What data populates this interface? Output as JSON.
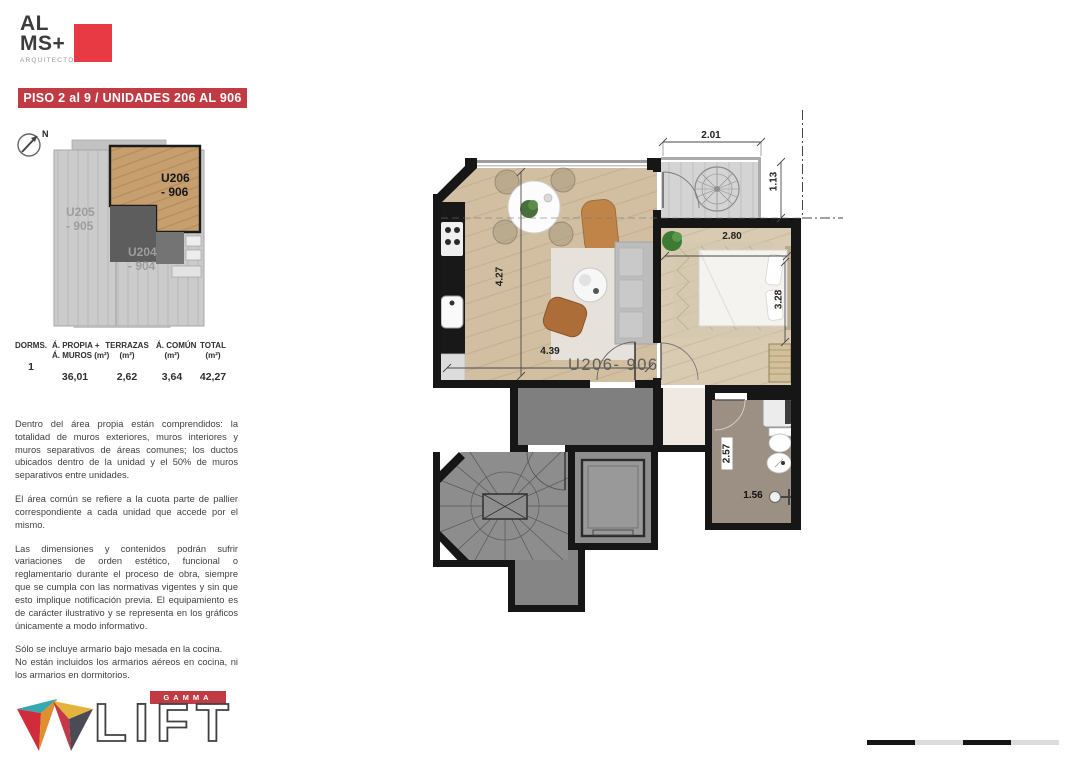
{
  "header": {
    "logo_line1": "AL",
    "logo_line2": "MS+",
    "logo_subtitle": "ARQUITECTOS",
    "banner": "PISO 2 al 9 / UNIDADES 206 AL 906"
  },
  "keyplan": {
    "north_label": "N",
    "units": {
      "u205_line1": "U205",
      "u205_line2": "- 905",
      "u206_line1": "U206",
      "u206_line2": "- 906",
      "u204_line1": "U204",
      "u204_line2": "- 904"
    }
  },
  "table": {
    "columns": [
      {
        "h1": "DORMS.",
        "h2": "",
        "value": "1"
      },
      {
        "h1": "Á. PROPIA +",
        "h2": "Á. MUROS (m²)",
        "value": "36,01"
      },
      {
        "h1": "TERRAZAS",
        "h2": "(m²)",
        "value": "2,62"
      },
      {
        "h1": "Á. COMÚN",
        "h2": "(m²)",
        "value": "3,64"
      },
      {
        "h1": "TOTAL",
        "h2": "(m²)",
        "value": "42,27"
      }
    ]
  },
  "notes": {
    "p1": "Dentro del área propia están comprendidos: la totalidad de muros exteriores, muros interiores y muros separativos de áreas comunes; los ductos ubicados dentro de la unidad y el 50% de muros separativos entre unidades.",
    "p2": "El área común se refiere a la cuota parte de pallier correspondiente a cada unidad que accede por el mismo.",
    "p3": "Las dimensiones y contenidos podrán sufrir variaciones de orden estético, funcional o reglamentario durante el proceso de obra, siempre que se cumpla con las normativas vigentes y sin que esto implique notificación previa. El equipamiento es de carácter ilustrativo y se representa en los gráficos únicamente a modo informativo.",
    "p4_line1": "Sólo se incluye armario bajo mesada en la cocina.",
    "p4_line2": "No están incluidos los armarios aéreos en cocina, ni los armarios en dormitorios."
  },
  "plan": {
    "unit_label": "U206- 906",
    "dims": {
      "terrace_width": "2.01",
      "terrace_depth": "1.13",
      "bedroom_width": "2.80",
      "bedroom_depth": "3.28",
      "living_depth": "4.27",
      "living_width": "4.39",
      "bath_depth": "2.57",
      "bath_width": "1.56"
    }
  },
  "footer": {
    "brand_top": "GAMMA",
    "brand_main": "LIFT"
  },
  "colors": {
    "accent_red": "#c13b44",
    "logo_red": "#e83a42",
    "wall_black": "#161616",
    "wood_floor": "#d2bfa2",
    "bedroom_floor": "#d9cbb1",
    "terrace_gray": "#d4d4d4",
    "bath_floor": "#9c9084",
    "common_gray": "#7f7f7f"
  }
}
